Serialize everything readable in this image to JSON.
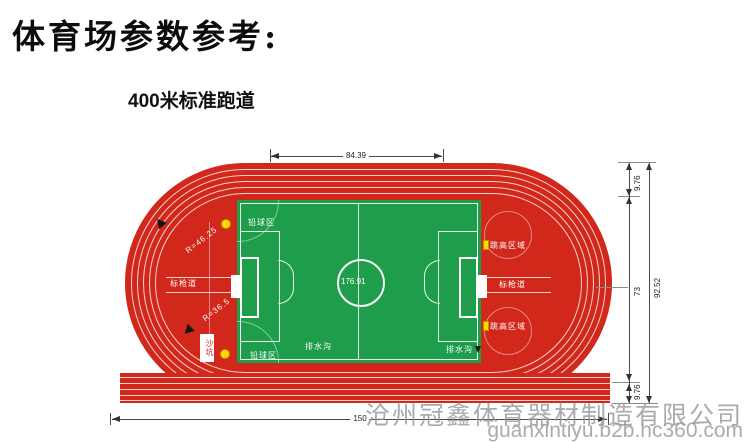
{
  "page": {
    "title": "体育场参数参考:",
    "subtitle": "400米标准跑道"
  },
  "track": {
    "center_length": "176.91",
    "radius_outer": "R=46.25",
    "radius_inner": "R=36.5"
  },
  "areas": {
    "javelin_left": "标枪道",
    "javelin_right": "标枪道",
    "high_jump_top": "跳高区域",
    "high_jump_bottom": "跳高区域",
    "shot_put_top": "铅球区",
    "shot_put_bottom": "铅球区",
    "drain_center": "排水沟",
    "drain_right": "排水沟",
    "sand_pit": "沙坑"
  },
  "dimensions": {
    "straight_length": "84.39",
    "track_width_top": "9.76",
    "infield_height": "73",
    "track_width_bottom": "9.76",
    "overall_height": "92.52",
    "overall_length": "150"
  },
  "colors": {
    "track_red": "#d2271b",
    "field_green": "#1e9e4a",
    "marker_yellow": "#ffd800",
    "lane_line_white": "#ffffff",
    "dimension_black": "#333333",
    "watermark_gray": "#969696"
  },
  "watermark": {
    "company": "沧州冠鑫体育器材制造有限公司",
    "url": "guanxintiyu.b2b.hc360.com"
  }
}
